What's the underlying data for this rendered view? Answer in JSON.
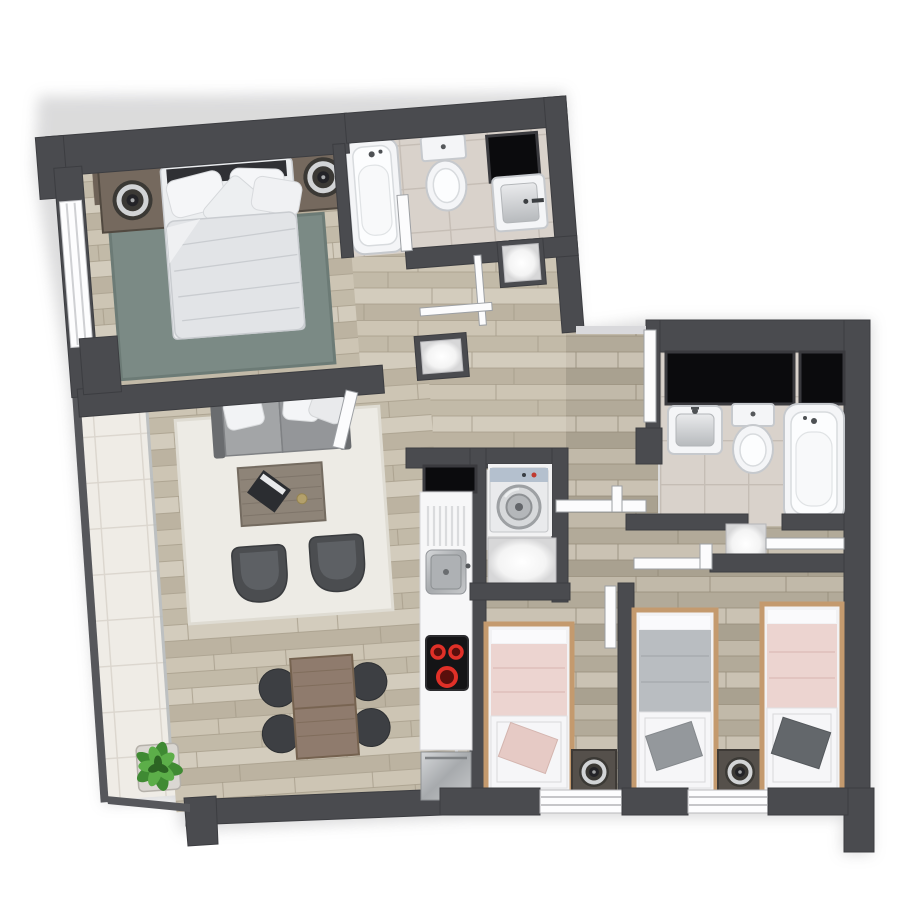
{
  "title": "apartment floor plan",
  "legend": {
    "floor_plan": "apartment floor plan",
    "master_bedroom": "master bedroom",
    "bathroom_1": "bathroom with bathtub, toilet and sink",
    "bathroom_2": "second bathroom with sink, toilet and bathtub",
    "living_room": "living room with sofa, armchairs and coffee table",
    "dining_area": "dining table with four chairs",
    "kitchen": "kitchen counter with sink and cooktop",
    "laundry": "utility closet with washing machine",
    "entry": "entry hall with cabinets",
    "hallway": "hallway",
    "bedroom_2": "single bedroom",
    "bedroom_3": "twin bedroom",
    "balcony": "balcony with plant",
    "double_bed": "double bed",
    "single_bed": "single bed",
    "nightstand": "nightstand with lamp",
    "rug": "rug",
    "sofa": "sofa",
    "armchair": "armchair",
    "coffee_table": "coffee table",
    "dining_table": "dining table",
    "washing_machine": "washing machine",
    "bathtub": "bathtub",
    "toilet": "toilet",
    "sink": "sink",
    "cooktop": "cooktop",
    "window": "window",
    "open_door": "open door leaf",
    "plant": "potted plant"
  },
  "counts": {
    "bedrooms": 3,
    "bathrooms": 2,
    "single_beds": 3,
    "double_beds": 1,
    "dining_chairs": 4,
    "armchairs": 2
  },
  "palette": {
    "wall": "#4a4b4f",
    "wall-dark": "#3c3d41",
    "wall-light": "#56575b",
    "door": "#fcfcfd",
    "door-line": "#9da0a4",
    "porc": "#f4f5f7",
    "porc-line": "#c6c9cd",
    "porc-in": "#fcfdfe",
    "porc-in-line": "#d8dbde",
    "black": "#0b0b0d",
    "frame": "#3a3a3e",
    "rug-teal": "#7b8a85",
    "rug-teal-line": "#6c7b76",
    "rug-cream": "#edebe5",
    "rug-cream-line": "#dfdcd3",
    "sofa-frame": "#5f6164",
    "sofa-arm": "#6a6c6f",
    "sofa-c1": "#a3a5a7",
    "sofa-c2": "#949699",
    "sofa-div": "#7f8184",
    "chair": "#4b4d50",
    "chair-in": "#5d6064",
    "ctable": "#8e8478",
    "ctable-line": "#746b60",
    "dtable": "#8f7b6d",
    "dtable-line": "#75624f",
    "dchair": "#3d3f43",
    "nstand": "#75695e",
    "nstand-line": "#514940",
    "nstand2": "#55504b",
    "lamp-base": "#3b3935",
    "lamp-ring": "#d2d4d6",
    "lamp-center": "#232327",
    "bed-frame": "#c49a6e",
    "pink": "#ecd4d0",
    "pink-line": "#dfbfba",
    "gray-bl": "#b9bdc1",
    "gray-bl-line": "#a8acb0",
    "cushion-pink": "#e6cac5",
    "cushion-gray": "#94989c",
    "cushion-dark": "#63676b",
    "duvet": "#e2e4e7",
    "duvet-line": "#c9ccd0",
    "steel1": "#d2d4d6",
    "steel2": "#a0a3a6",
    "red": "#e03028",
    "red-dark": "#5a0f0c",
    "washer-top": "#b4c0ce",
    "glass": "#b4b8ba",
    "pot": "#dad7d2",
    "leaf1": "#3f8a33",
    "leaf2": "#5cae49",
    "leaf3": "#2c6423",
    "plank-a1": "#cdc5b4",
    "plank-a2": "#c2baa8",
    "plank-a3": "#d3ccbd",
    "plank-a4": "#bcb3a1",
    "plank-line-a": "#a59c89",
    "plank-b1": "#c1b9a9",
    "plank-b2": "#b2aa99",
    "plank-b3": "#cac2b3",
    "plank-b4": "#a9a190",
    "plank-line-b": "#958c79",
    "tile": "#d9d2cb",
    "tile-line": "#c5bdb5",
    "btile": "#efece6",
    "btile-line": "#dbd6ce"
  }
}
